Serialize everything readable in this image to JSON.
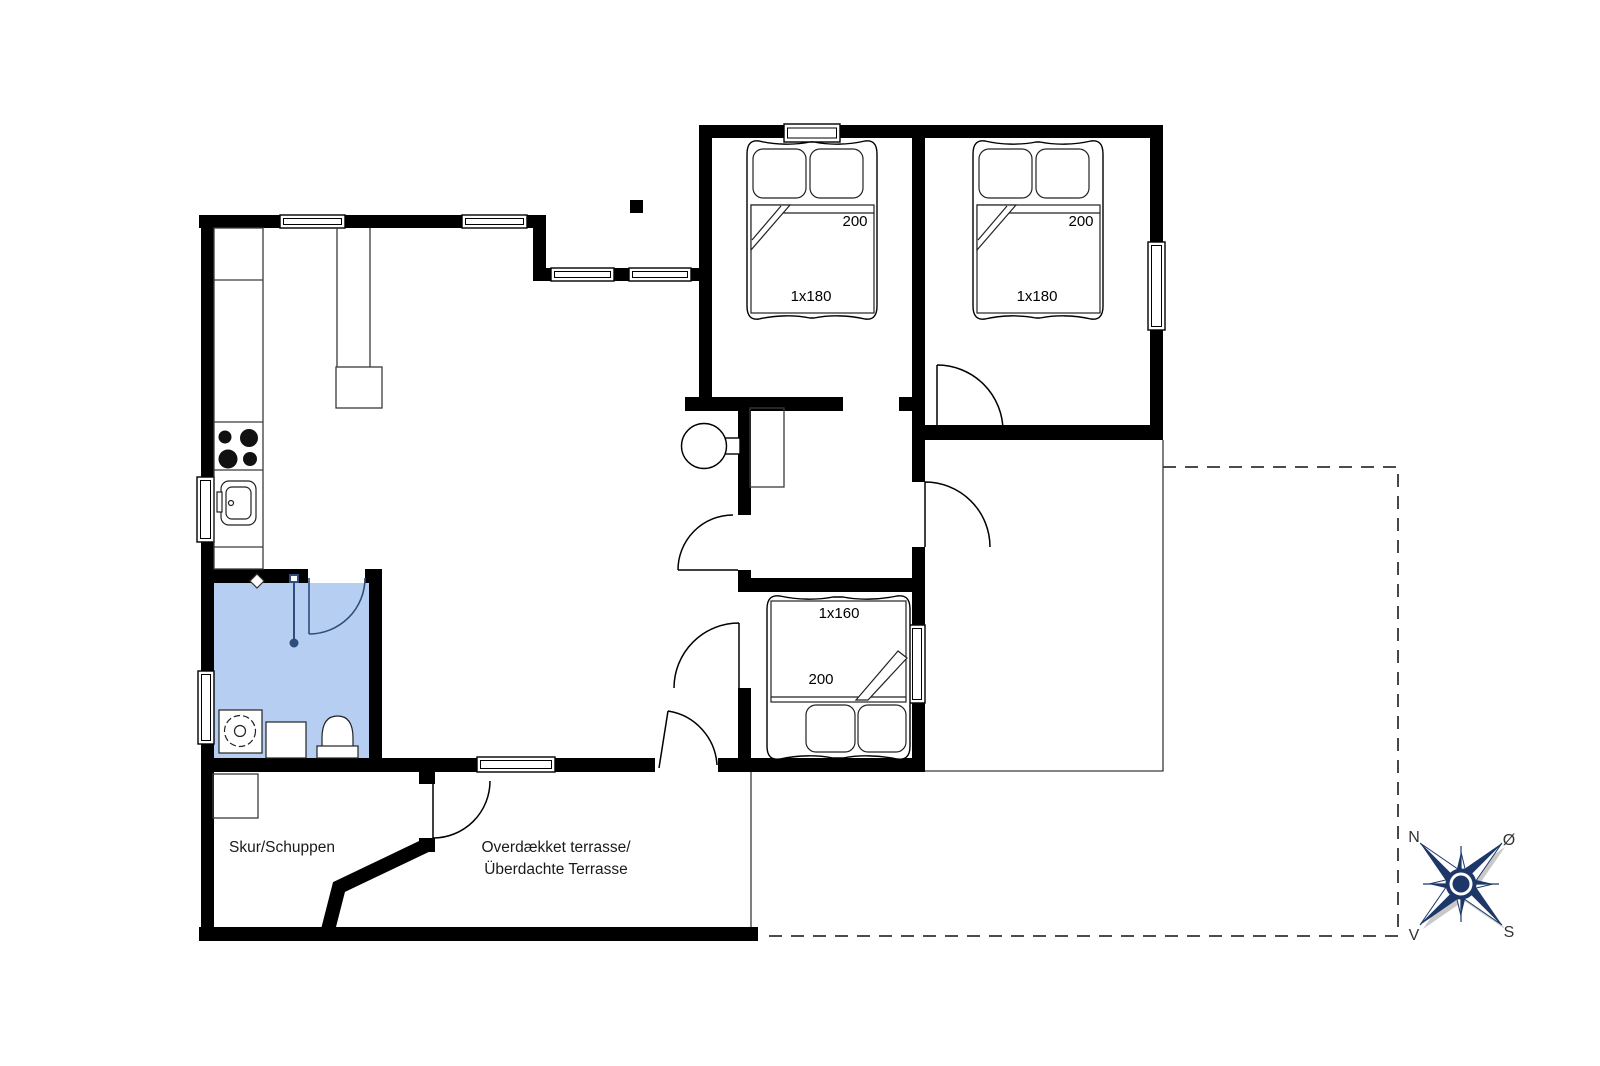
{
  "floorplan": {
    "labels": {
      "shed": "Skur/Schuppen",
      "terrace_line1": "Overdækket terrasse/",
      "terrace_line2": "Überdachte Terrasse"
    },
    "beds": {
      "bed1": {
        "length": "200",
        "size": "1x180"
      },
      "bed2": {
        "length": "200",
        "size": "1x180"
      },
      "bed3": {
        "length": "200",
        "size": "1x160"
      }
    },
    "compass": {
      "n": "N",
      "e": "Ø",
      "s": "S",
      "w": "V"
    },
    "colors": {
      "wall": "#000000",
      "bathroom_fill": "#b5cef1",
      "bathroom_accent": "#2e4d7b",
      "compass_navy": "#1c3768",
      "compass_shadow": "#c9c9c9",
      "text": "#1a1a1a"
    }
  }
}
